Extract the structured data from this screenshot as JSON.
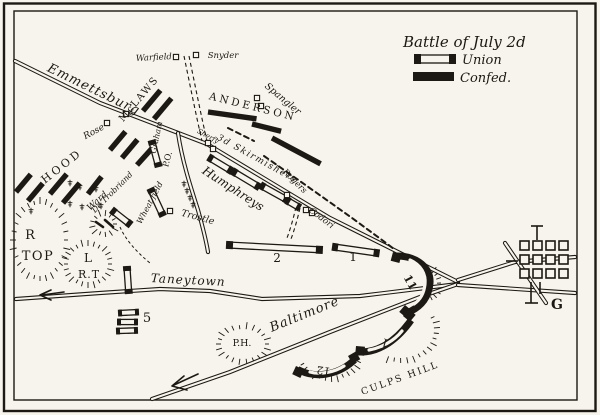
{
  "colors": {
    "ink": "#1c1813",
    "paper": "#f6f4ec"
  },
  "legend": {
    "title": "Battle of July 2d",
    "union": "Union",
    "confed": "Confed."
  },
  "roads": {
    "emmitsburg": "Emmettsburg",
    "taneytown": "Taneytown",
    "baltimore": "Baltimore"
  },
  "confederate": {
    "hood": "HOOD",
    "mclaws": "McLAWS",
    "anderson": "ANDERSON"
  },
  "union": {
    "humphreys": "Humphreys",
    "graham": "Graham",
    "de_trobriand": "De Trobriand",
    "ward": "Ward",
    "skirmishers": "3d Skirmishers",
    "corps_2": "2",
    "corps_1": "1",
    "corps_5": "5",
    "corps_11": "11",
    "corps_12": "12",
    "corps_1_culps": "1"
  },
  "places": {
    "warfield": "Warfield",
    "snyder": "Snyder",
    "spangler": "Spangler",
    "rose": "Rose",
    "sherfy": "Sherfy",
    "trostle": "Trostle",
    "rogers": "Rogers",
    "codori": "Codori",
    "wheat_field": "Wheat field",
    "peach_orchard": "P.O.",
    "round_top_r": "R",
    "round_top": "TOP",
    "little_round_top_l": "L",
    "little_round_top": "R.T",
    "powers_hill": "P.H.",
    "culps_hill": "CULPS HILL",
    "gettysburg": "G"
  }
}
